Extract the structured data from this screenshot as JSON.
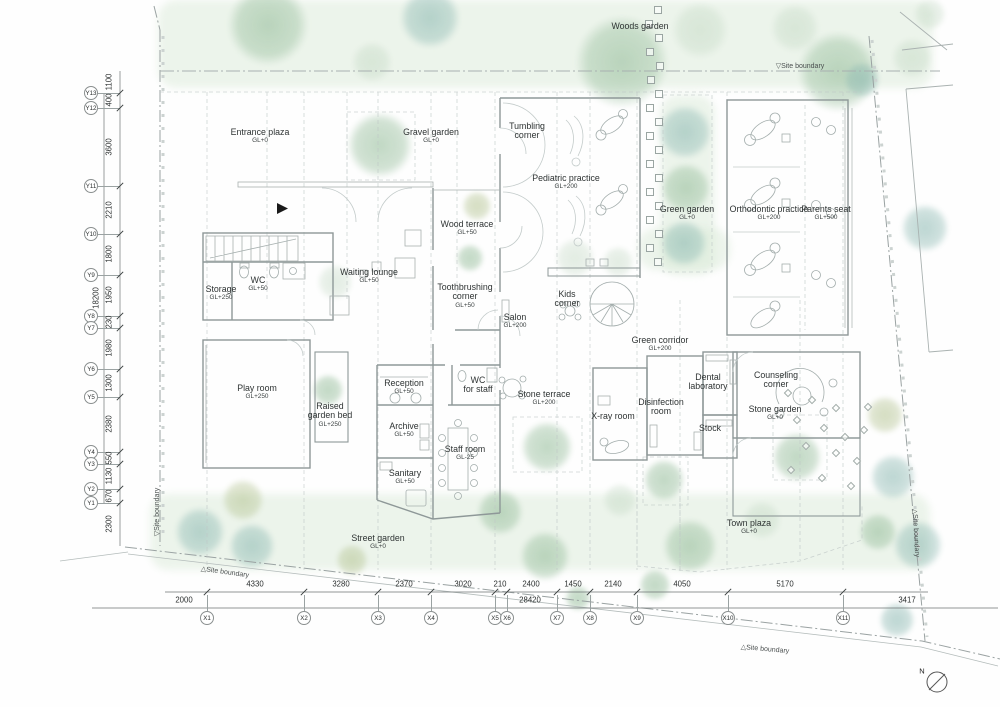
{
  "north": {
    "label": "N"
  },
  "rooms": [
    {
      "id": "woods-garden",
      "lines": [
        "Woods garden"
      ],
      "x": 640,
      "y": 27
    },
    {
      "id": "entrance-plaza",
      "lines": [
        "Entrance plaza"
      ],
      "gl": "GL+0",
      "x": 260,
      "y": 133
    },
    {
      "id": "gravel-garden",
      "lines": [
        "Gravel garden"
      ],
      "gl": "GL+0",
      "x": 431,
      "y": 133
    },
    {
      "id": "tumbling-corner",
      "lines": [
        "Tumbling",
        "corner"
      ],
      "x": 527,
      "y": 127
    },
    {
      "id": "pediatric-practice",
      "lines": [
        "Pediatric practice"
      ],
      "gl": "GL+200",
      "x": 566,
      "y": 179
    },
    {
      "id": "green-garden",
      "lines": [
        "Green garden"
      ],
      "gl": "GL+0",
      "x": 687,
      "y": 210
    },
    {
      "id": "orthodontic-practice",
      "lines": [
        "Orthodontic practice"
      ],
      "gl": "GL+200",
      "x": 769,
      "y": 210
    },
    {
      "id": "parents-seat",
      "lines": [
        "Parents seat"
      ],
      "gl": "GL+500",
      "x": 826,
      "y": 210
    },
    {
      "id": "wood-terrace",
      "lines": [
        "Wood terrace"
      ],
      "gl": "GL+50",
      "x": 467,
      "y": 225
    },
    {
      "id": "waiting-lounge",
      "lines": [
        "Waiting lounge"
      ],
      "gl": "GL+50",
      "x": 369,
      "y": 273
    },
    {
      "id": "storage",
      "lines": [
        "Storage"
      ],
      "gl": "GL+250",
      "x": 221,
      "y": 290
    },
    {
      "id": "wc",
      "lines": [
        "WC"
      ],
      "gl": "GL+50",
      "x": 258,
      "y": 281
    },
    {
      "id": "toothbrushing-corner",
      "lines": [
        "Toothbrushing",
        "corner"
      ],
      "gl": "GL+50",
      "x": 465,
      "y": 288
    },
    {
      "id": "salon",
      "lines": [
        "Salon"
      ],
      "gl": "GL+200",
      "x": 515,
      "y": 318
    },
    {
      "id": "kids-corner",
      "lines": [
        "Kids",
        "corner"
      ],
      "x": 567,
      "y": 295
    },
    {
      "id": "green-corridor",
      "lines": [
        "Green corridor"
      ],
      "gl": "GL+200",
      "x": 660,
      "y": 341
    },
    {
      "id": "play-room",
      "lines": [
        "Play room"
      ],
      "gl": "GL+250",
      "x": 257,
      "y": 389
    },
    {
      "id": "raised-garden-bed",
      "lines": [
        "Raised",
        "garden bed"
      ],
      "gl": "GL+250",
      "x": 330,
      "y": 407
    },
    {
      "id": "reception",
      "lines": [
        "Reception"
      ],
      "gl": "GL+50",
      "x": 404,
      "y": 384
    },
    {
      "id": "wc-for-staff",
      "lines": [
        "WC",
        "for staff"
      ],
      "x": 478,
      "y": 381
    },
    {
      "id": "stone-terrace",
      "lines": [
        "Stone terrace"
      ],
      "gl": "GL+200",
      "x": 544,
      "y": 395
    },
    {
      "id": "x-ray-room",
      "lines": [
        "X-ray room"
      ],
      "x": 613,
      "y": 417
    },
    {
      "id": "disinfection-room",
      "lines": [
        "Disinfection",
        "room"
      ],
      "x": 661,
      "y": 403
    },
    {
      "id": "dental-laboratory",
      "lines": [
        "Dental",
        "laboratory"
      ],
      "x": 708,
      "y": 378
    },
    {
      "id": "counseling-corner",
      "lines": [
        "Counseling",
        "corner"
      ],
      "x": 776,
      "y": 376
    },
    {
      "id": "stock",
      "lines": [
        "Stock"
      ],
      "x": 710,
      "y": 429
    },
    {
      "id": "stone-garden",
      "lines": [
        "Stone garden"
      ],
      "gl": "GL+0",
      "x": 775,
      "y": 410
    },
    {
      "id": "archive",
      "lines": [
        "Archive"
      ],
      "gl": "GL+50",
      "x": 404,
      "y": 427
    },
    {
      "id": "staff-room",
      "lines": [
        "Staff room"
      ],
      "gl": "GL-25",
      "x": 465,
      "y": 450
    },
    {
      "id": "sanitary",
      "lines": [
        "Sanitary"
      ],
      "gl": "GL+50",
      "x": 405,
      "y": 474
    },
    {
      "id": "street-garden",
      "lines": [
        "Street garden"
      ],
      "gl": "GL+0",
      "x": 378,
      "y": 539
    },
    {
      "id": "town-plaza",
      "lines": [
        "Town plaza"
      ],
      "gl": "GL+0",
      "x": 749,
      "y": 524
    }
  ],
  "boundaries": [
    {
      "id": "site-boundary-top",
      "text": "▽Site  boundary",
      "x": 800,
      "y": 66,
      "rot": 0
    },
    {
      "id": "site-boundary-left",
      "text": "▽Site  boundary",
      "x": 157,
      "y": 512,
      "rot": -90
    },
    {
      "id": "site-boundary-bottom-left",
      "text": "△Site  boundary",
      "x": 225,
      "y": 572,
      "rot": 8
    },
    {
      "id": "site-boundary-bottom-right",
      "text": "△Site  boundary",
      "x": 765,
      "y": 649,
      "rot": 5
    },
    {
      "id": "site-boundary-right",
      "text": "△Site  boundary",
      "x": 916,
      "y": 533,
      "rot": 87
    }
  ],
  "ygrid": {
    "x": 91,
    "bubbles": [
      {
        "label": "Y13",
        "y": 93
      },
      {
        "label": "Y12",
        "y": 108
      },
      {
        "label": "Y11",
        "y": 186
      },
      {
        "label": "Y10",
        "y": 234
      },
      {
        "label": "Y9",
        "y": 275
      },
      {
        "label": "Y8",
        "y": 316
      },
      {
        "label": "Y7",
        "y": 328
      },
      {
        "label": "Y6",
        "y": 369
      },
      {
        "label": "Y5",
        "y": 397
      },
      {
        "label": "Y4",
        "y": 452
      },
      {
        "label": "Y3",
        "y": 464
      },
      {
        "label": "Y2",
        "y": 489
      },
      {
        "label": "Y1",
        "y": 503
      }
    ],
    "dims": [
      {
        "v": "1100",
        "y": 82
      },
      {
        "v": "400",
        "y": 100
      },
      {
        "v": "3600",
        "y": 147
      },
      {
        "v": "2210",
        "y": 210
      },
      {
        "v": "1800",
        "y": 254
      },
      {
        "v": "1950",
        "y": 295
      },
      {
        "v": "230",
        "y": 322
      },
      {
        "v": "1980",
        "y": 348
      },
      {
        "v": "1300",
        "y": 383
      },
      {
        "v": "2380",
        "y": 424
      },
      {
        "v": "550",
        "y": 458
      },
      {
        "v": "1130",
        "y": 476
      },
      {
        "v": "670",
        "y": 496
      },
      {
        "v": "2300",
        "y": 524
      }
    ],
    "overall": {
      "v": "18200",
      "x": 96,
      "y": 298
    }
  },
  "xgrid": {
    "y": 618,
    "bubbles": [
      {
        "label": "X1",
        "x": 207
      },
      {
        "label": "X2",
        "x": 304
      },
      {
        "label": "X3",
        "x": 378
      },
      {
        "label": "X4",
        "x": 431
      },
      {
        "label": "X5",
        "x": 495
      },
      {
        "label": "X6",
        "x": 507
      },
      {
        "label": "X7",
        "x": 557
      },
      {
        "label": "X8",
        "x": 590
      },
      {
        "label": "X9",
        "x": 637
      },
      {
        "label": "X10",
        "x": 728
      },
      {
        "label": "X11",
        "x": 843
      }
    ],
    "dims": [
      {
        "v": "4330",
        "x": 255
      },
      {
        "v": "3280",
        "x": 341
      },
      {
        "v": "2370",
        "x": 404
      },
      {
        "v": "3020",
        "x": 463
      },
      {
        "v": "210",
        "x": 500
      },
      {
        "v": "2400",
        "x": 531
      },
      {
        "v": "1450",
        "x": 573
      },
      {
        "v": "2140",
        "x": 613
      },
      {
        "v": "4050",
        "x": 682
      },
      {
        "v": "5170",
        "x": 785
      }
    ],
    "totals": [
      {
        "v": "2000",
        "x": 184
      },
      {
        "v": "28420",
        "x": 530
      },
      {
        "v": "3417",
        "x": 907
      }
    ]
  },
  "trees": [
    [
      268,
      25,
      40,
      "tg"
    ],
    [
      430,
      18,
      30,
      "tb"
    ],
    [
      372,
      62,
      20,
      "tp"
    ],
    [
      622,
      62,
      46,
      "tg"
    ],
    [
      700,
      30,
      28,
      "tp"
    ],
    [
      838,
      72,
      40,
      "tg"
    ],
    [
      795,
      28,
      24,
      "tp"
    ],
    [
      930,
      14,
      16,
      "tp"
    ],
    [
      862,
      80,
      18,
      "tb"
    ],
    [
      912,
      58,
      20,
      "tp"
    ],
    [
      380,
      145,
      33,
      "tg"
    ],
    [
      335,
      282,
      18,
      "tp"
    ],
    [
      477,
      206,
      15,
      "to"
    ],
    [
      470,
      258,
      14,
      "tg"
    ],
    [
      685,
      132,
      27,
      "tb"
    ],
    [
      686,
      188,
      25,
      "tg"
    ],
    [
      684,
      243,
      23,
      "tb"
    ],
    [
      575,
      258,
      20,
      "tp"
    ],
    [
      618,
      262,
      16,
      "tp"
    ],
    [
      328,
      390,
      16,
      "tg"
    ],
    [
      547,
      447,
      26,
      "tg"
    ],
    [
      664,
      480,
      21,
      "tg"
    ],
    [
      797,
      457,
      25,
      "tg"
    ],
    [
      885,
      415,
      19,
      "to"
    ],
    [
      893,
      477,
      23,
      "tb"
    ],
    [
      925,
      228,
      24,
      "tb"
    ],
    [
      918,
      545,
      25,
      "tb"
    ],
    [
      897,
      620,
      18,
      "tb"
    ],
    [
      200,
      532,
      25,
      "tb"
    ],
    [
      243,
      500,
      21,
      "to"
    ],
    [
      252,
      546,
      23,
      "tb"
    ],
    [
      352,
      560,
      16,
      "to"
    ],
    [
      500,
      512,
      23,
      "tg"
    ],
    [
      545,
      556,
      25,
      "tg"
    ],
    [
      578,
      598,
      13,
      "tg"
    ],
    [
      655,
      585,
      16,
      "tg"
    ],
    [
      690,
      546,
      27,
      "tg"
    ],
    [
      620,
      500,
      17,
      "tp"
    ],
    [
      762,
      520,
      19,
      "tp"
    ],
    [
      878,
      532,
      19,
      "tg"
    ]
  ],
  "stepping_stones": [
    [
      658,
      10
    ],
    [
      649,
      24
    ],
    [
      659,
      38
    ],
    [
      650,
      52
    ],
    [
      660,
      66
    ],
    [
      651,
      80
    ],
    [
      659,
      94
    ],
    [
      650,
      108
    ],
    [
      659,
      122
    ],
    [
      650,
      136
    ],
    [
      659,
      150
    ],
    [
      650,
      164
    ],
    [
      659,
      178
    ],
    [
      650,
      192
    ],
    [
      659,
      206
    ],
    [
      650,
      220
    ],
    [
      659,
      234
    ],
    [
      650,
      248
    ],
    [
      658,
      262
    ]
  ],
  "garden_diamonds": [
    [
      788,
      393
    ],
    [
      812,
      400
    ],
    [
      836,
      408
    ],
    [
      797,
      420
    ],
    [
      824,
      428
    ],
    [
      845,
      437
    ],
    [
      806,
      446
    ],
    [
      836,
      453
    ],
    [
      857,
      461
    ],
    [
      791,
      470
    ],
    [
      822,
      478
    ],
    [
      851,
      486
    ],
    [
      864,
      430
    ],
    [
      868,
      407
    ]
  ]
}
